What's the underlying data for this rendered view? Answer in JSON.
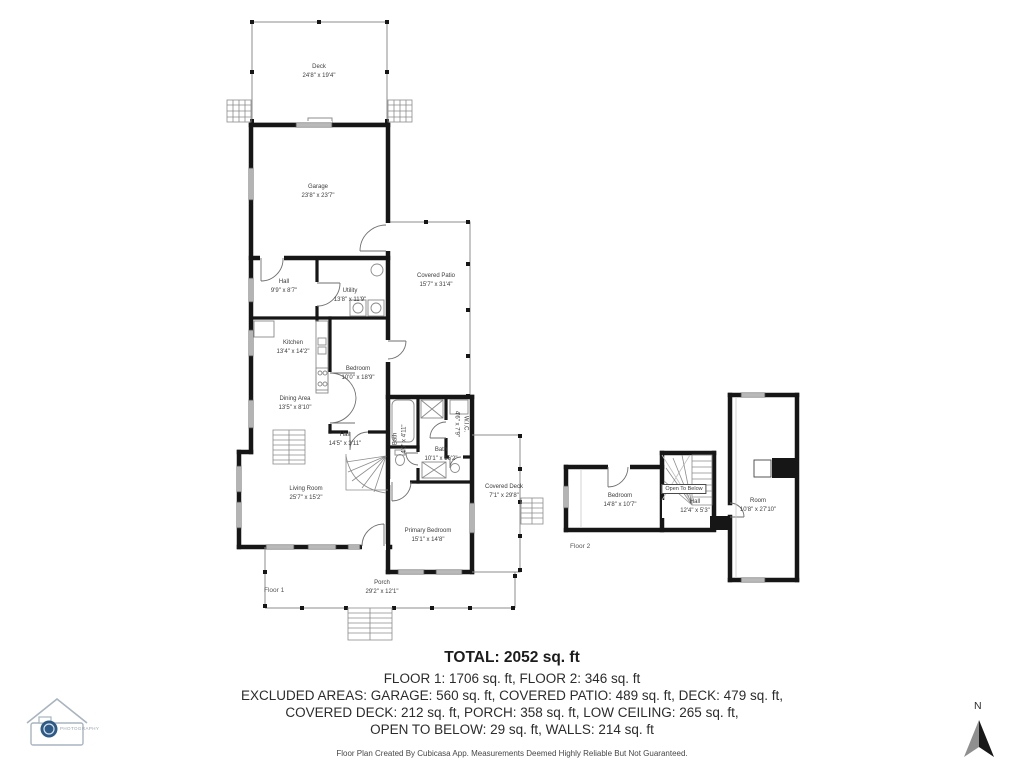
{
  "floor1": {
    "label": "Floor 1",
    "deck": {
      "name": "Deck",
      "dims": "24'8\" x 19'4\""
    },
    "garage": {
      "name": "Garage",
      "dims": "23'8\" x 23'7\""
    },
    "hall_upper": {
      "name": "Hall",
      "dims": "9'9\" x 8'7\""
    },
    "utility": {
      "name": "Utility",
      "dims": "13'8\" x 11'9\""
    },
    "covered_patio": {
      "name": "Covered Patio",
      "dims": "15'7\" x 31'4\""
    },
    "kitchen": {
      "name": "Kitchen",
      "dims": "13'4\" x 14'2\""
    },
    "bedroom": {
      "name": "Bedroom",
      "dims": "10'0\" x 18'9\""
    },
    "dining_area": {
      "name": "Dining Area",
      "dims": "13'5\" x 8'10\""
    },
    "hall_lower": {
      "name": "Hall",
      "dims": "14'5\" x 3'11\""
    },
    "living_room": {
      "name": "Living Room",
      "dims": "25'7\" x 15'2\""
    },
    "bath_small": {
      "name": "Bath",
      "dims": "4'6\" x 4'11\""
    },
    "bath": {
      "name": "Bath",
      "dims": "10'1\" x 16'2\""
    },
    "wic": {
      "name": "W.I.C.",
      "dims": "4'6\" x 7'9\""
    },
    "primary_bedroom": {
      "name": "Primary Bedroom",
      "dims": "15'1\" x 14'8\""
    },
    "covered_deck": {
      "name": "Covered Deck",
      "dims": "7'1\" x 29'8\""
    },
    "porch": {
      "name": "Porch",
      "dims": "29'2\" x 12'1\""
    }
  },
  "floor2": {
    "label": "Floor 2",
    "bedroom": {
      "name": "Bedroom",
      "dims": "14'8\" x 10'7\""
    },
    "open_to_below": {
      "name": "Open To Below"
    },
    "hall": {
      "name": "Hall",
      "dims": "12'4\" x 5'3\""
    },
    "room": {
      "name": "Room",
      "dims": "10'8\" x 27'10\""
    }
  },
  "summary": {
    "total": "TOTAL: 2052 sq. ft",
    "floors": "FLOOR 1: 1706 sq. ft, FLOOR 2: 346 sq. ft",
    "excluded1": "EXCLUDED AREAS: GARAGE: 560 sq. ft, COVERED PATIO: 489 sq. ft, DECK: 479 sq. ft,",
    "excluded2": "COVERED DECK: 212 sq. ft, PORCH: 358 sq. ft, LOW CEILING: 265 sq. ft,",
    "excluded3": "OPEN TO BELOW: 29 sq. ft, WALLS: 214 sq. ft",
    "footer": "Floor Plan Created By Cubicasa App. Measurements Deemed Highly Reliable But Not Guaranteed."
  },
  "compass": {
    "label": "N"
  },
  "logo": {
    "text": "PHOTOGRAPHY"
  },
  "colors": {
    "wall": "#161616",
    "thin_line": "#8c8c8c",
    "logo_blue": "#2d5a87"
  }
}
